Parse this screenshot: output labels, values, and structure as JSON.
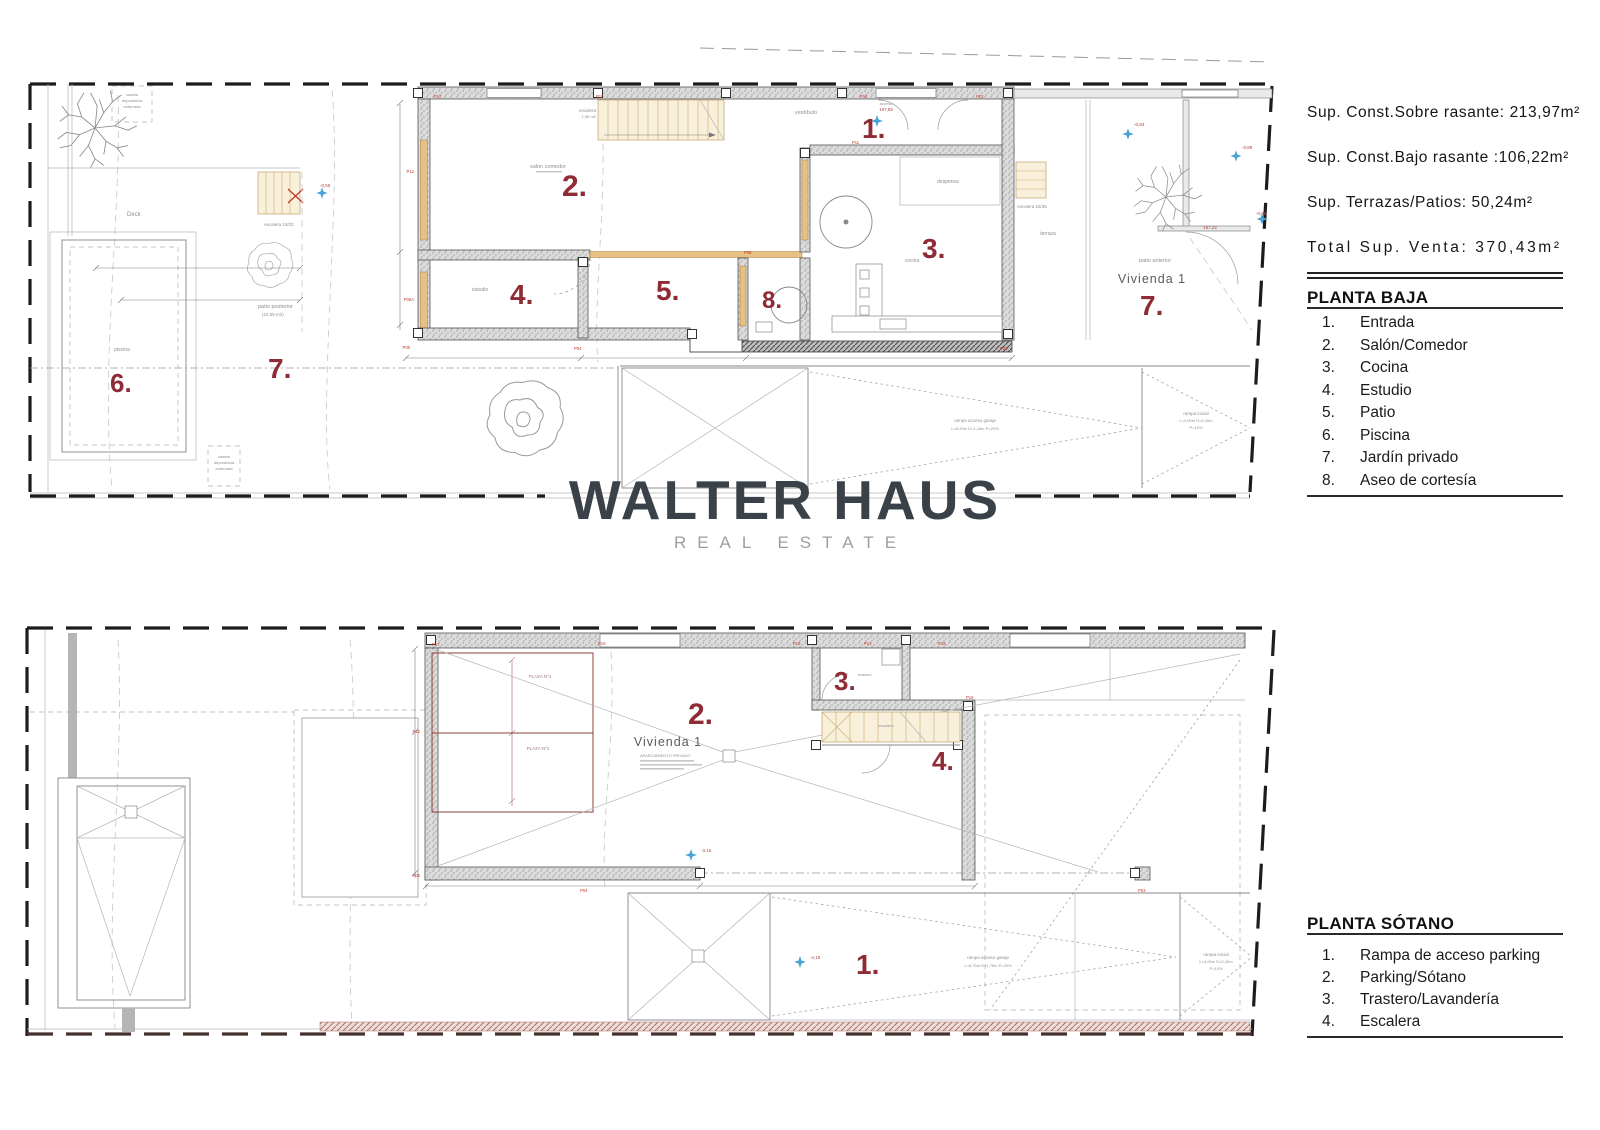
{
  "logo": {
    "title": "WALTER HAUS",
    "subtitle": "REAL ESTATE"
  },
  "side": {
    "summary": [
      "Sup. Const.Sobre rasante: 213,97m²",
      "Sup. Const.Bajo rasante :106,22m²",
      "Sup. Terrazas/Patios: 50,24m²",
      "Total Sup. Venta: 370,43m²"
    ],
    "baja": {
      "title": "PLANTA BAJA",
      "items": [
        {
          "n": "1.",
          "t": "Entrada"
        },
        {
          "n": "2.",
          "t": "Salón/Comedor"
        },
        {
          "n": "3.",
          "t": "Cocina"
        },
        {
          "n": "4.",
          "t": "Estudio"
        },
        {
          "n": "5.",
          "t": "Patio"
        },
        {
          "n": "6.",
          "t": "Piscina"
        },
        {
          "n": "7.",
          "t": "Jardín privado"
        },
        {
          "n": "8.",
          "t": "Aseo de cortesía"
        }
      ]
    },
    "sotano": {
      "title": "PLANTA SÓTANO",
      "items": [
        {
          "n": "1.",
          "t": "Rampa de acceso parking"
        },
        {
          "n": "2.",
          "t": "Parking/Sótano"
        },
        {
          "n": "3.",
          "t": "Trastero/Lavandería"
        },
        {
          "n": "4.",
          "t": "Escalera"
        }
      ]
    }
  },
  "pb": {
    "n": {
      "n1": "1.",
      "n2": "2.",
      "n3": "3.",
      "n4": "4.",
      "n5": "5.",
      "n6": "6.",
      "n7": "7.",
      "n7b": "7.",
      "n8": "8."
    },
    "t": {
      "deck": "Deck",
      "piscina": "piscina",
      "escalera_ext": "escalera 18/32",
      "patio_posterior": "patio posterior",
      "patio_posterior_area": "(24,59 m2)",
      "caseta1": "caseta",
      "caseta2": "depuradora",
      "caseta3": "enterrada",
      "salon": "salon comedor",
      "escalera_int": "escalera",
      "escalera_int_area": "1,58 m2",
      "vestibulo": "vestíbulo",
      "despensa": "despensa",
      "cocina": "cocina",
      "estudio": "estudio",
      "terraza": "terraza",
      "escalera_der": "escalera 15/35",
      "patio_anterior": "patio anterior",
      "vivienda": "Vivienda 1",
      "acceso": "acceso",
      "rampa1": "rampa acceso garaje",
      "rampa1_d": "L=8,20m D=1,44m P=20%",
      "rampa2": "rampa inicial",
      "rampa2_d": "L=4,00m D=0,40m",
      "rampa2_p": "P=10%"
    },
    "lv": {
      "a19788": "197,88",
      "a19722": "197,22",
      "m083": "-0,83",
      "m089": "-0,89",
      "m088": "-0,88",
      "m055": "-0,55"
    },
    "posts": {
      "p17": "P17",
      "p10": "P10",
      "p14": "P14",
      "p13": "P13",
      "p11": "P11",
      "p12": "P12",
      "p06a": "P06A",
      "p05": "P05",
      "p04": "P04",
      "p01": "P01",
      "p08": "P08"
    }
  },
  "ps": {
    "n": {
      "n1": "1.",
      "n2": "2.",
      "n3": "3.",
      "n4": "4."
    },
    "t": {
      "plaza1": "PLAZA Nº1",
      "plaza2": "PLAZA Nº2",
      "vivienda": "Vivienda 1",
      "aparcamiento": "APARCAMIENTO PRIVADO",
      "trastero": "trastero",
      "escalera": "escalera",
      "rampa1": "rampa acceso garaje",
      "rampa1_d": "L=8,75m D=1,75m P=20%",
      "rampa2": "rampa inicial",
      "rampa2_d": "L=4,00m D=0,40m",
      "rampa2_p": "P=10%"
    },
    "lv": {
      "m315": "-3,15",
      "m415": "-4,15"
    },
    "posts": {
      "p17": "P17",
      "p19": "P19",
      "p15": "P15",
      "p14": "P14",
      "p13": "P13",
      "p16": "P16",
      "p12": "P12",
      "p05": "P05",
      "p04": "P04",
      "p03": "P03"
    }
  }
}
